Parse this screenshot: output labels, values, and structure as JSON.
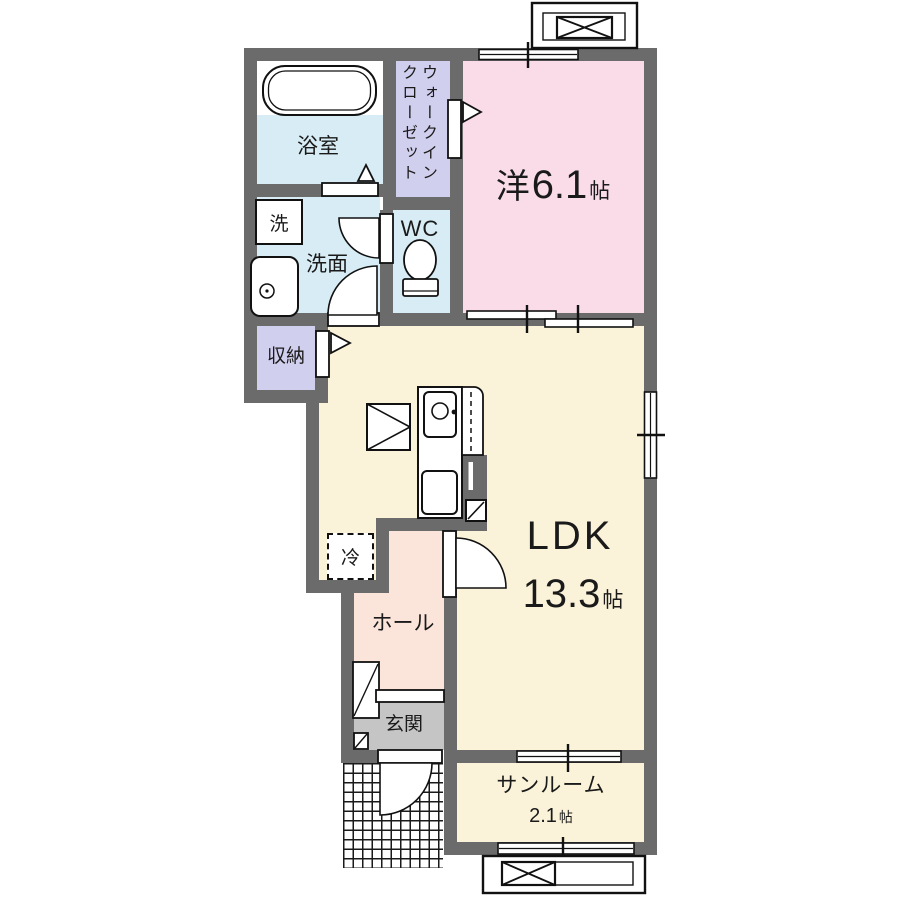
{
  "floorplan": {
    "title": "1LDK apartment floor plan",
    "colors": {
      "wall": "#6b6b6b",
      "wet_area_blue": "#d7ecf4",
      "closet_lavender": "#d1cfee",
      "bedroom_pink": "#fadce9",
      "ldk_cream": "#faf3d9",
      "hall_peach": "#fbe5da",
      "entrance_gray": "#c5c5c5"
    },
    "rooms": {
      "bath": {
        "label": "浴室"
      },
      "laundry": {
        "label": "洗"
      },
      "washroom": {
        "label": "洗面"
      },
      "wic": {
        "line1": "ウォークイン",
        "line2": "クローゼット"
      },
      "wc": {
        "label": "WC"
      },
      "western_room": {
        "label": "洋",
        "size": "6.1",
        "unit": "帖"
      },
      "storage": {
        "label": "収納"
      },
      "fridge": {
        "label": "冷"
      },
      "ldk": {
        "label": "LDK",
        "size": "13.3",
        "unit": "帖"
      },
      "hall": {
        "label": "ホール"
      },
      "entrance": {
        "label": "玄関"
      },
      "sunroom": {
        "label": "サンルーム",
        "size": "2.1",
        "unit": "帖"
      }
    }
  }
}
